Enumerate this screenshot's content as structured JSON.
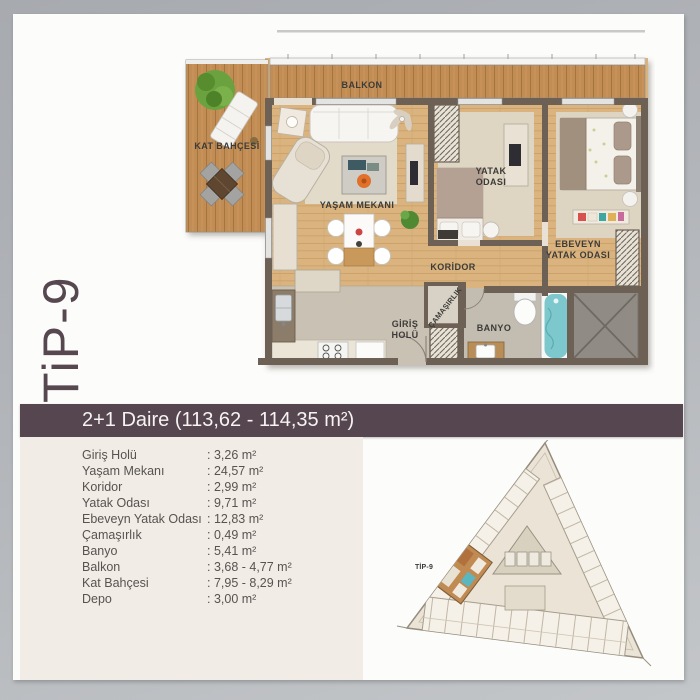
{
  "page": {
    "type_label": "TiP-9",
    "title": "2+1 Daire (113,62 - 114,35 m²)"
  },
  "rooms": [
    {
      "label": "Giriş Holü",
      "value": ": 3,26 m²"
    },
    {
      "label": "Yaşam Mekanı",
      "value": ": 24,57 m²"
    },
    {
      "label": "Koridor",
      "value": ": 2,99 m²"
    },
    {
      "label": "Yatak Odası",
      "value": ": 9,71 m²"
    },
    {
      "label": "Ebeveyn Yatak Odası",
      "value": ": 12,83 m²"
    },
    {
      "label": "Çamaşırlık",
      "value": ": 0,49 m²"
    },
    {
      "label": "Banyo",
      "value": ": 5,41 m²"
    },
    {
      "label": "Balkon",
      "value": ": 3,68 - 4,77 m²"
    },
    {
      "label": "Kat Bahçesi",
      "value": ": 7,95 - 8,29 m²"
    },
    {
      "label": "Depo",
      "value": ": 3,00 m²"
    }
  ],
  "floorplan": {
    "labels": {
      "balkon": "BALKON",
      "kat_bahcesi": "KAT BAHÇESİ",
      "yasam_mekani": "YAŞAM MEKANI",
      "yatak_line1": "YATAK",
      "yatak_line2": "ODASI",
      "ebeveyn_line1": "EBEVEYN",
      "ebeveyn_line2": "YATAK ODASI",
      "koridor": "KORİDOR",
      "giris_line1": "GİRİŞ",
      "giris_line2": "HOLÜ",
      "camasirlik": "ÇAMAŞIRLIK",
      "banyo": "BANYO"
    }
  },
  "siteplan": {
    "unit_label": "TİP-9"
  },
  "colors": {
    "accent": "#564650",
    "panel": "#f1ece5",
    "frame": "#b2b5b9",
    "deck_wood": "#c28d55",
    "floor_wood": "#dab37e",
    "tub_water": "#7cc8cd"
  }
}
